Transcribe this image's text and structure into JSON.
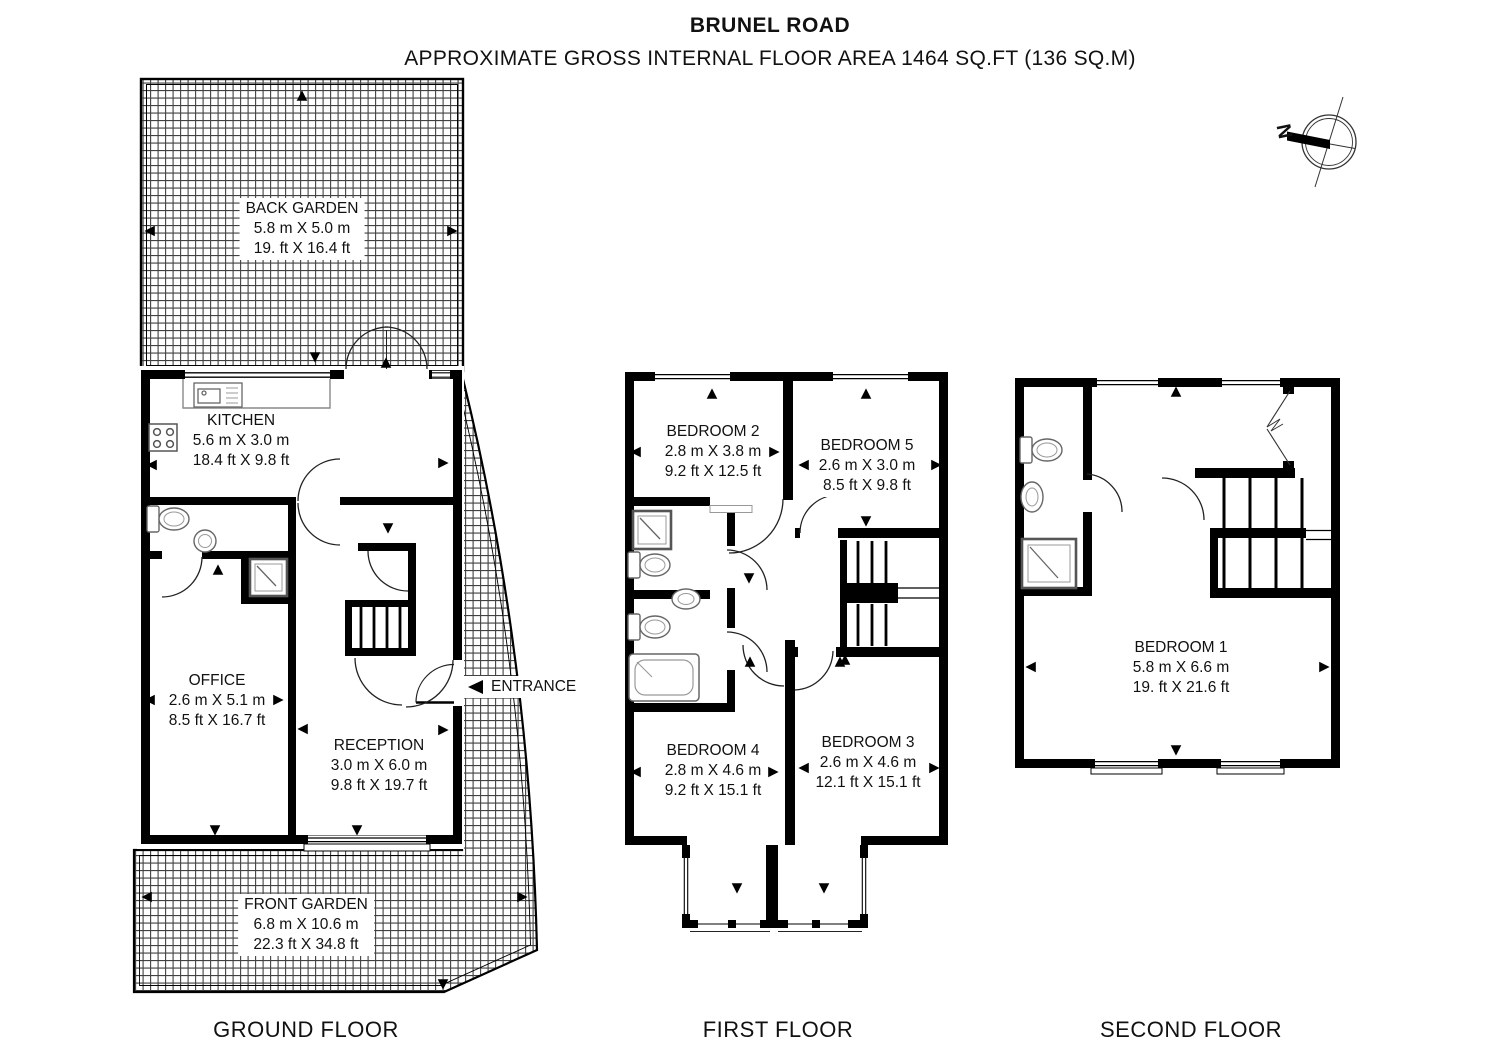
{
  "title": {
    "line1": "BRUNEL ROAD",
    "line2": "APPROXIMATE GROSS INTERNAL FLOOR AREA 1464 SQ.FT (136 SQ.M)"
  },
  "compass": {
    "north_label": "N"
  },
  "entrance": {
    "label": "ENTRANCE"
  },
  "colors": {
    "wall": "#000000",
    "hatch_line": "#414141",
    "fixture_line": "#5f5f5f"
  },
  "floors": {
    "ground": {
      "label": "GROUND FLOOR",
      "rooms": {
        "back_garden": {
          "name": "BACK GARDEN",
          "metric": "5.8 m X 5.0 m",
          "imperial": "19. ft X 16.4 ft"
        },
        "kitchen": {
          "name": "KITCHEN",
          "metric": "5.6 m X 3.0 m",
          "imperial": "18.4 ft X 9.8 ft"
        },
        "office": {
          "name": "OFFICE",
          "metric": "2.6 m X 5.1 m",
          "imperial": "8.5 ft X 16.7 ft"
        },
        "reception": {
          "name": "RECEPTION",
          "metric": "3.0 m X 6.0 m",
          "imperial": "9.8 ft X 19.7 ft"
        },
        "front_garden": {
          "name": "FRONT GARDEN",
          "metric": "6.8 m X 10.6 m",
          "imperial": "22.3 ft X 34.8 ft"
        }
      }
    },
    "first": {
      "label": "FIRST FLOOR",
      "rooms": {
        "bedroom2": {
          "name": "BEDROOM 2",
          "metric": "2.8 m X 3.8 m",
          "imperial": "9.2 ft X 12.5 ft"
        },
        "bedroom5": {
          "name": "BEDROOM 5",
          "metric": "2.6 m X 3.0 m",
          "imperial": "8.5 ft X 9.8 ft"
        },
        "bedroom4": {
          "name": "BEDROOM 4",
          "metric": "2.8 m X 4.6 m",
          "imperial": "9.2 ft X 15.1 ft"
        },
        "bedroom3": {
          "name": "BEDROOM 3",
          "metric": "2.6 m X 4.6 m",
          "imperial": "12.1 ft X 15.1 ft"
        }
      }
    },
    "second": {
      "label": "SECOND FLOOR",
      "rooms": {
        "bedroom1": {
          "name": "BEDROOM 1",
          "metric": "5.8 m X 6.6 m",
          "imperial": "19. ft X 21.6 ft"
        }
      }
    }
  }
}
